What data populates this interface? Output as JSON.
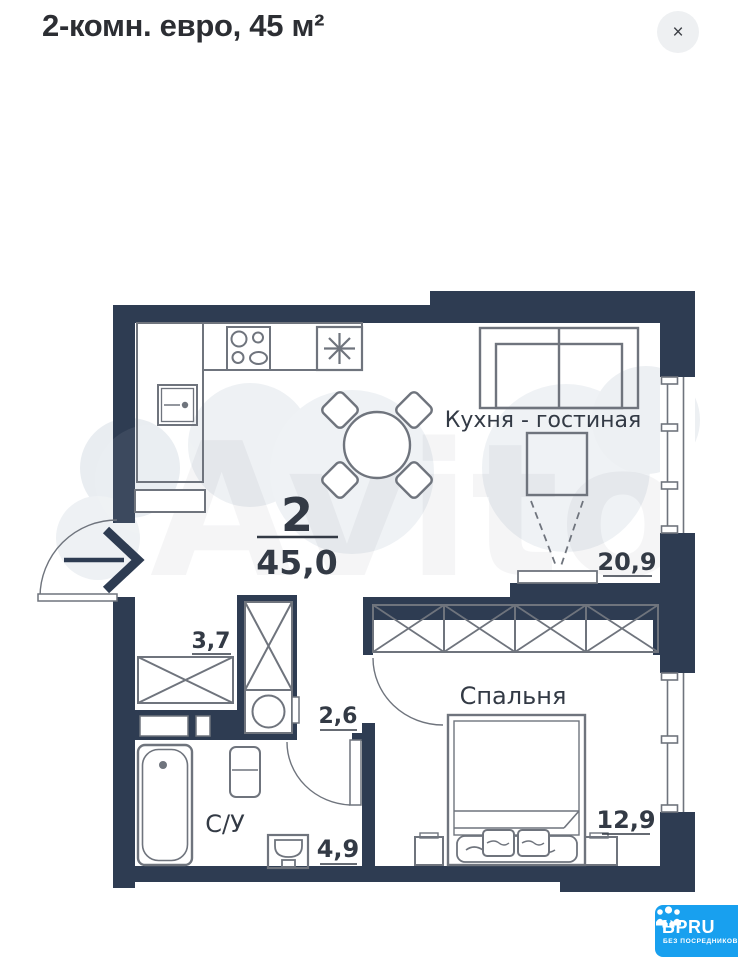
{
  "header": {
    "title": "2-комн. евро, 45 м²",
    "close_label": "×"
  },
  "plan": {
    "total": {
      "rooms": "2",
      "area": "45,0"
    },
    "kitchen_living": {
      "name": "Кухня - гостиная",
      "area": "20,9"
    },
    "bedroom": {
      "name": "Спальня",
      "area": "12,9"
    },
    "bathroom": {
      "name": "С/У",
      "area": "4,9"
    },
    "hallway": {
      "area": "3,7"
    },
    "corridor": {
      "area": "2,6"
    },
    "watermark": "Avito"
  },
  "logo": {
    "brand": "BPRU",
    "tagline": "БЕЗ ПОСРЕДНИКОВ"
  },
  "colors": {
    "wall": "#2e3c52",
    "outline": "#6f747d",
    "label": "#333a45",
    "brand_blue": "#18a0ef",
    "close_bg": "#eef0f2"
  }
}
